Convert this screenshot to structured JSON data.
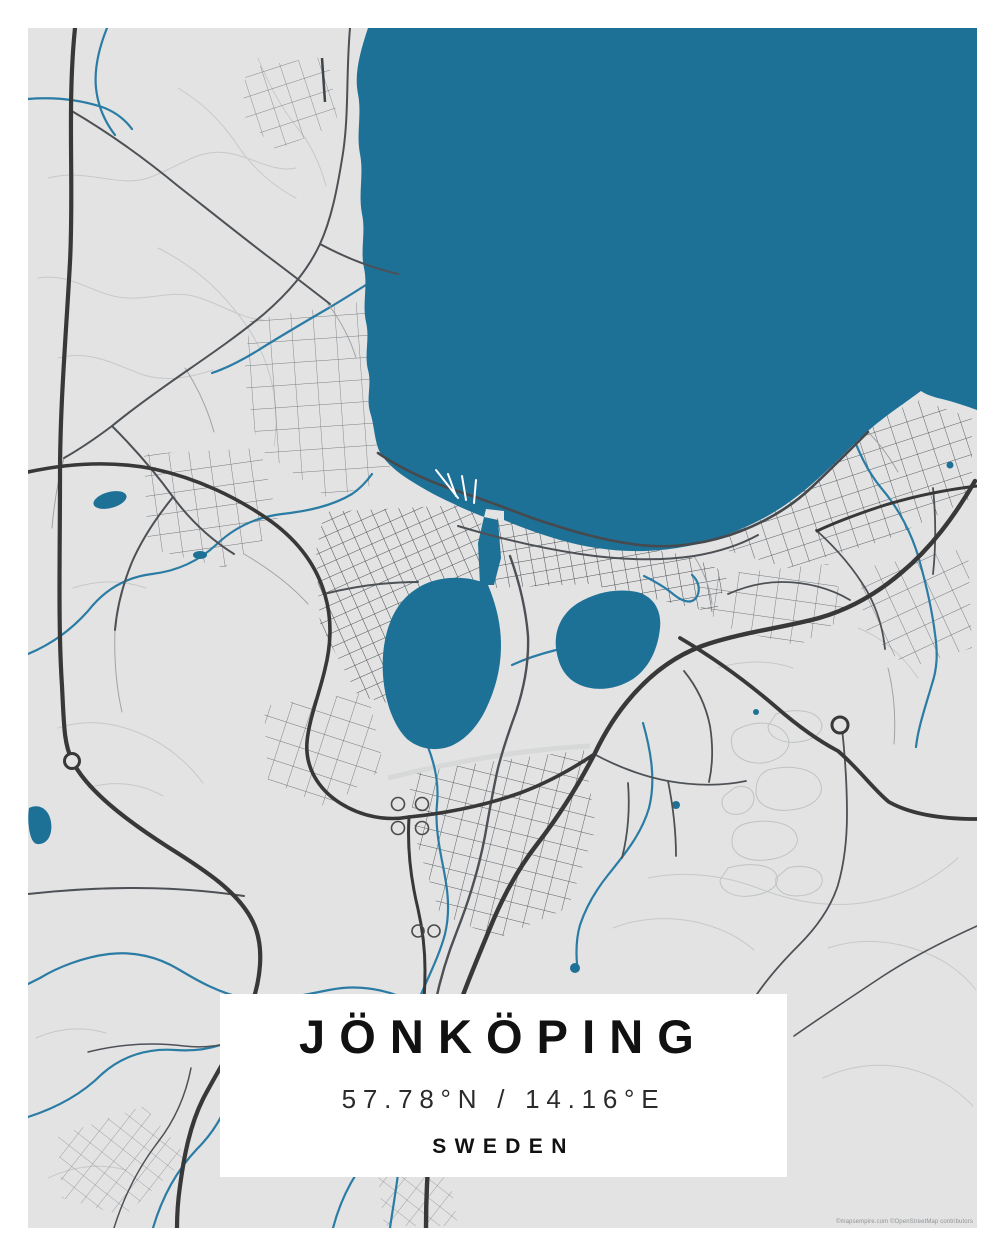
{
  "poster": {
    "title": "JÖNKÖPING",
    "coordinates": "57.78°N / 14.16°E",
    "country": "SWEDEN",
    "attribution": "©mapsempire.com ©OpenStreetMap contributors"
  },
  "map": {
    "colors": {
      "water": "#1E7196",
      "land": "#E3E3E3",
      "road_major": "#383838",
      "road_medium": "#4D5156",
      "road_minor": "#9FA3A6",
      "path_light": "#C6C8CA",
      "stream": "#2B7CA4",
      "frame": "#FFFFFF",
      "text": "#111111"
    }
  }
}
